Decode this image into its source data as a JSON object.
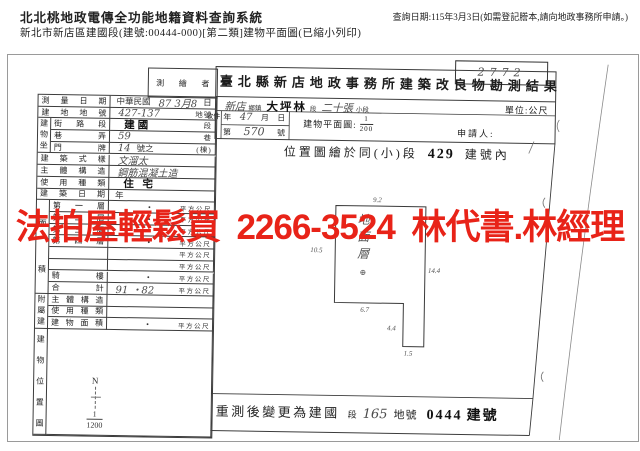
{
  "header": {
    "system_title": "北北桃地政電傳全功能地籍資料查詢系統",
    "query_note": "查詢日期:115年3月3日(如需登記謄本,請向地政事務所申請。)",
    "doc_line": "新北市新店區建國段(建號:00444-000)[第二類]建物平面圖(已縮小列印)"
  },
  "watermark": {
    "text": "法拍屋輕鬆買 2266-3524 林代書.林經理",
    "color": "#e82318"
  },
  "scan": {
    "corner_note": "2772",
    "office_title": "臺北縣新店地政事務所建築改良物勘測結果",
    "surveyor_label": "測繪者",
    "township": {
      "hand1": "新店",
      "label1": "鄉鎮",
      "hand2": "大坪林",
      "label2": "段",
      "hand3": "二十張",
      "label3": "小段"
    },
    "unit_note": "單位:公尺",
    "receipt": {
      "label": "收件",
      "date_pre": "年",
      "date_hand": "47",
      "date_mid": "月",
      "date_suf": "日",
      "no_pre": "第",
      "no_hand": "570",
      "no_suf": "號"
    },
    "scale": {
      "label": "建物平面圖:",
      "num": "1",
      "den": "200"
    },
    "applicant_label": "申請人:",
    "location_note": {
      "pre": "位置圖繪於同(小)段",
      "num": "429",
      "suf": "建號內"
    },
    "floor_plan": {
      "room": "地面層",
      "dim_top": "9.2",
      "dim_left": "10.5",
      "dim_right": "14.4",
      "dim_bottom": "6.7",
      "dim_tab": "4.4",
      "dim_tab_w": "1.5"
    },
    "compass": {
      "n": "N",
      "num": "1",
      "den": "1200"
    },
    "remeasure": {
      "p1": "重測後變更為建國",
      "p2": "段",
      "hand": "165",
      "p3": "地號",
      "stamp": "0444",
      "p4": "建號"
    },
    "table": {
      "map_cell_label": "建物位置圖",
      "rows": [
        {
          "label": "測量日期",
          "parts": [
            [
              "p",
              "中華民國"
            ],
            [
              "h",
              "87 3月8"
            ],
            [
              "p",
              "日"
            ]
          ]
        },
        {
          "label": "建地地號",
          "parts": [
            [
              "h",
              "427-137"
            ],
            [
              "pr",
              "地號"
            ]
          ]
        },
        {
          "group": "建物坐落",
          "gspan": 3,
          "label": "街路段",
          "parts": [
            [
              "s",
              "建國"
            ],
            [
              "pr",
              "段"
            ]
          ]
        },
        {
          "label": "巷弄",
          "parts": [
            [
              "h",
              "59"
            ],
            [
              "pr",
              "巷"
            ]
          ]
        },
        {
          "label": "門牌",
          "parts": [
            [
              "h",
              "14"
            ],
            [
              "p",
              "號之"
            ],
            [
              "pr",
              "(棟)"
            ]
          ]
        },
        {
          "label": "建築式樣",
          "parts": [
            [
              "h",
              "文溜太"
            ]
          ]
        },
        {
          "label": "主體構造",
          "parts": [
            [
              "h",
              "鋼筋混凝土造"
            ]
          ]
        },
        {
          "label": "使用種類",
          "parts": [
            [
              "s",
              "住 宅"
            ]
          ]
        },
        {
          "label": "建築日期",
          "parts": [
            [
              "p",
              "年"
            ]
          ]
        },
        {
          "group": "面積",
          "gspan": 8,
          "label": "第一層",
          "parts": [
            [
              "d",
              "・"
            ]
          ],
          "unit": "平方公尺"
        },
        {
          "label": "第二層",
          "parts": [
            [
              "d",
              "・"
            ]
          ],
          "unit": "平方公尺"
        },
        {
          "label": "第三層",
          "parts": [
            [
              "d",
              "・"
            ]
          ],
          "unit": "平方公尺"
        },
        {
          "label": "第四層",
          "parts": [
            [
              "d",
              "・"
            ]
          ],
          "unit": "平方公尺"
        },
        {
          "label": "",
          "parts": [],
          "unit": "平方公尺"
        },
        {
          "label": "",
          "parts": [],
          "unit": "平方公尺"
        },
        {
          "label": "騎樓",
          "parts": [
            [
              "d",
              "・"
            ]
          ],
          "unit": "平方公尺"
        },
        {
          "label": "合計",
          "parts": [
            [
              "h",
              "91 ・82"
            ]
          ],
          "unit": "平方公尺"
        },
        {
          "group": "附屬建物",
          "gspan": 3,
          "label": "主體構造",
          "parts": []
        },
        {
          "label": "使用種類",
          "parts": []
        },
        {
          "label": "建物面積",
          "parts": [
            [
              "d",
              "・"
            ]
          ],
          "unit": "平方公尺"
        }
      ]
    }
  }
}
